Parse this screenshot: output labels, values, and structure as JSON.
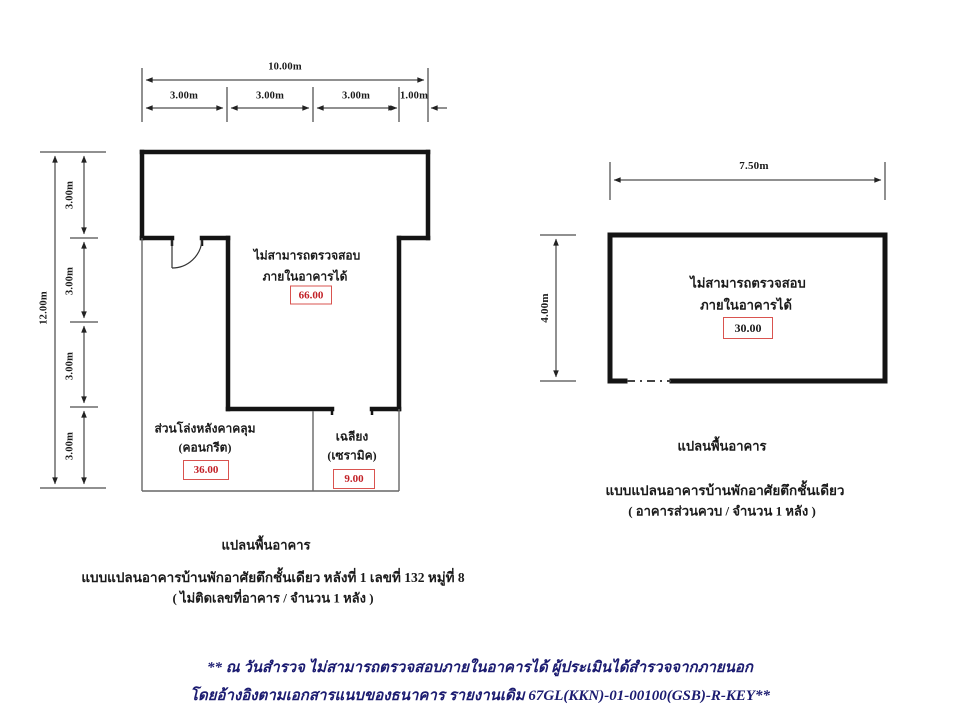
{
  "left_plan": {
    "dims": {
      "total_width": "10.00m",
      "width_segments": [
        "3.00m",
        "3.00m",
        "3.00m",
        "1.00m"
      ],
      "total_height": "12.00m",
      "height_segments": [
        "3.00m",
        "3.00m",
        "3.00m",
        "3.00m"
      ]
    },
    "rooms": {
      "main": {
        "note_line1": "ไม่สามารถตรวจสอบ",
        "note_line2": "ภายในอาคารได้",
        "area": "66.00"
      },
      "covered_open": {
        "label_line1": "ส่วนโล่งหลังคาคลุม",
        "label_line2": "(คอนกรีต)",
        "area": "36.00"
      },
      "porch": {
        "label_line1": "เฉลียง",
        "label_line2": "(เซรามิค)",
        "area": "9.00"
      }
    },
    "caption": {
      "title": "แปลนพื้นอาคาร",
      "line1": "แบบแปลนอาคารบ้านพักอาศัยตึกชั้นเดียว หลังที่ 1  เลขที่ 132  หมู่ที่ 8",
      "line2": "( ไม่ติดเลขที่อาคาร / จำนวน 1 หลัง )"
    }
  },
  "right_plan": {
    "dims": {
      "total_width": "7.50m",
      "total_height": "4.00m"
    },
    "rooms": {
      "main": {
        "note_line1": "ไม่สามารถตรวจสอบ",
        "note_line2": "ภายในอาคารได้",
        "area": "30.00"
      }
    },
    "caption": {
      "title": "แปลนพื้นอาคาร",
      "line1": "แบบแปลนอาคารบ้านพักอาศัยตึกชั้นเดียว",
      "line2": "( อาคารส่วนควบ / จำนวน 1 หลัง )"
    }
  },
  "footer": {
    "line1": "** ณ วันสำรวจ ไม่สามารถตรวจสอบภายในอาคารได้ ผู้ประเมินได้สำรวจจากภายนอก",
    "line2": "โดยอ้างอิงตามเอกสารแนบของธนาคาร รายงานเดิม 67GL(KKN)-01-00100(GSB)-R-KEY**"
  },
  "colors": {
    "wall": "#141414",
    "thin_wall": "#666666",
    "dimension": "#222222",
    "area_text_red": "#c22127",
    "area_box_border": "#d9534f",
    "footer_text": "#1b1b70"
  }
}
